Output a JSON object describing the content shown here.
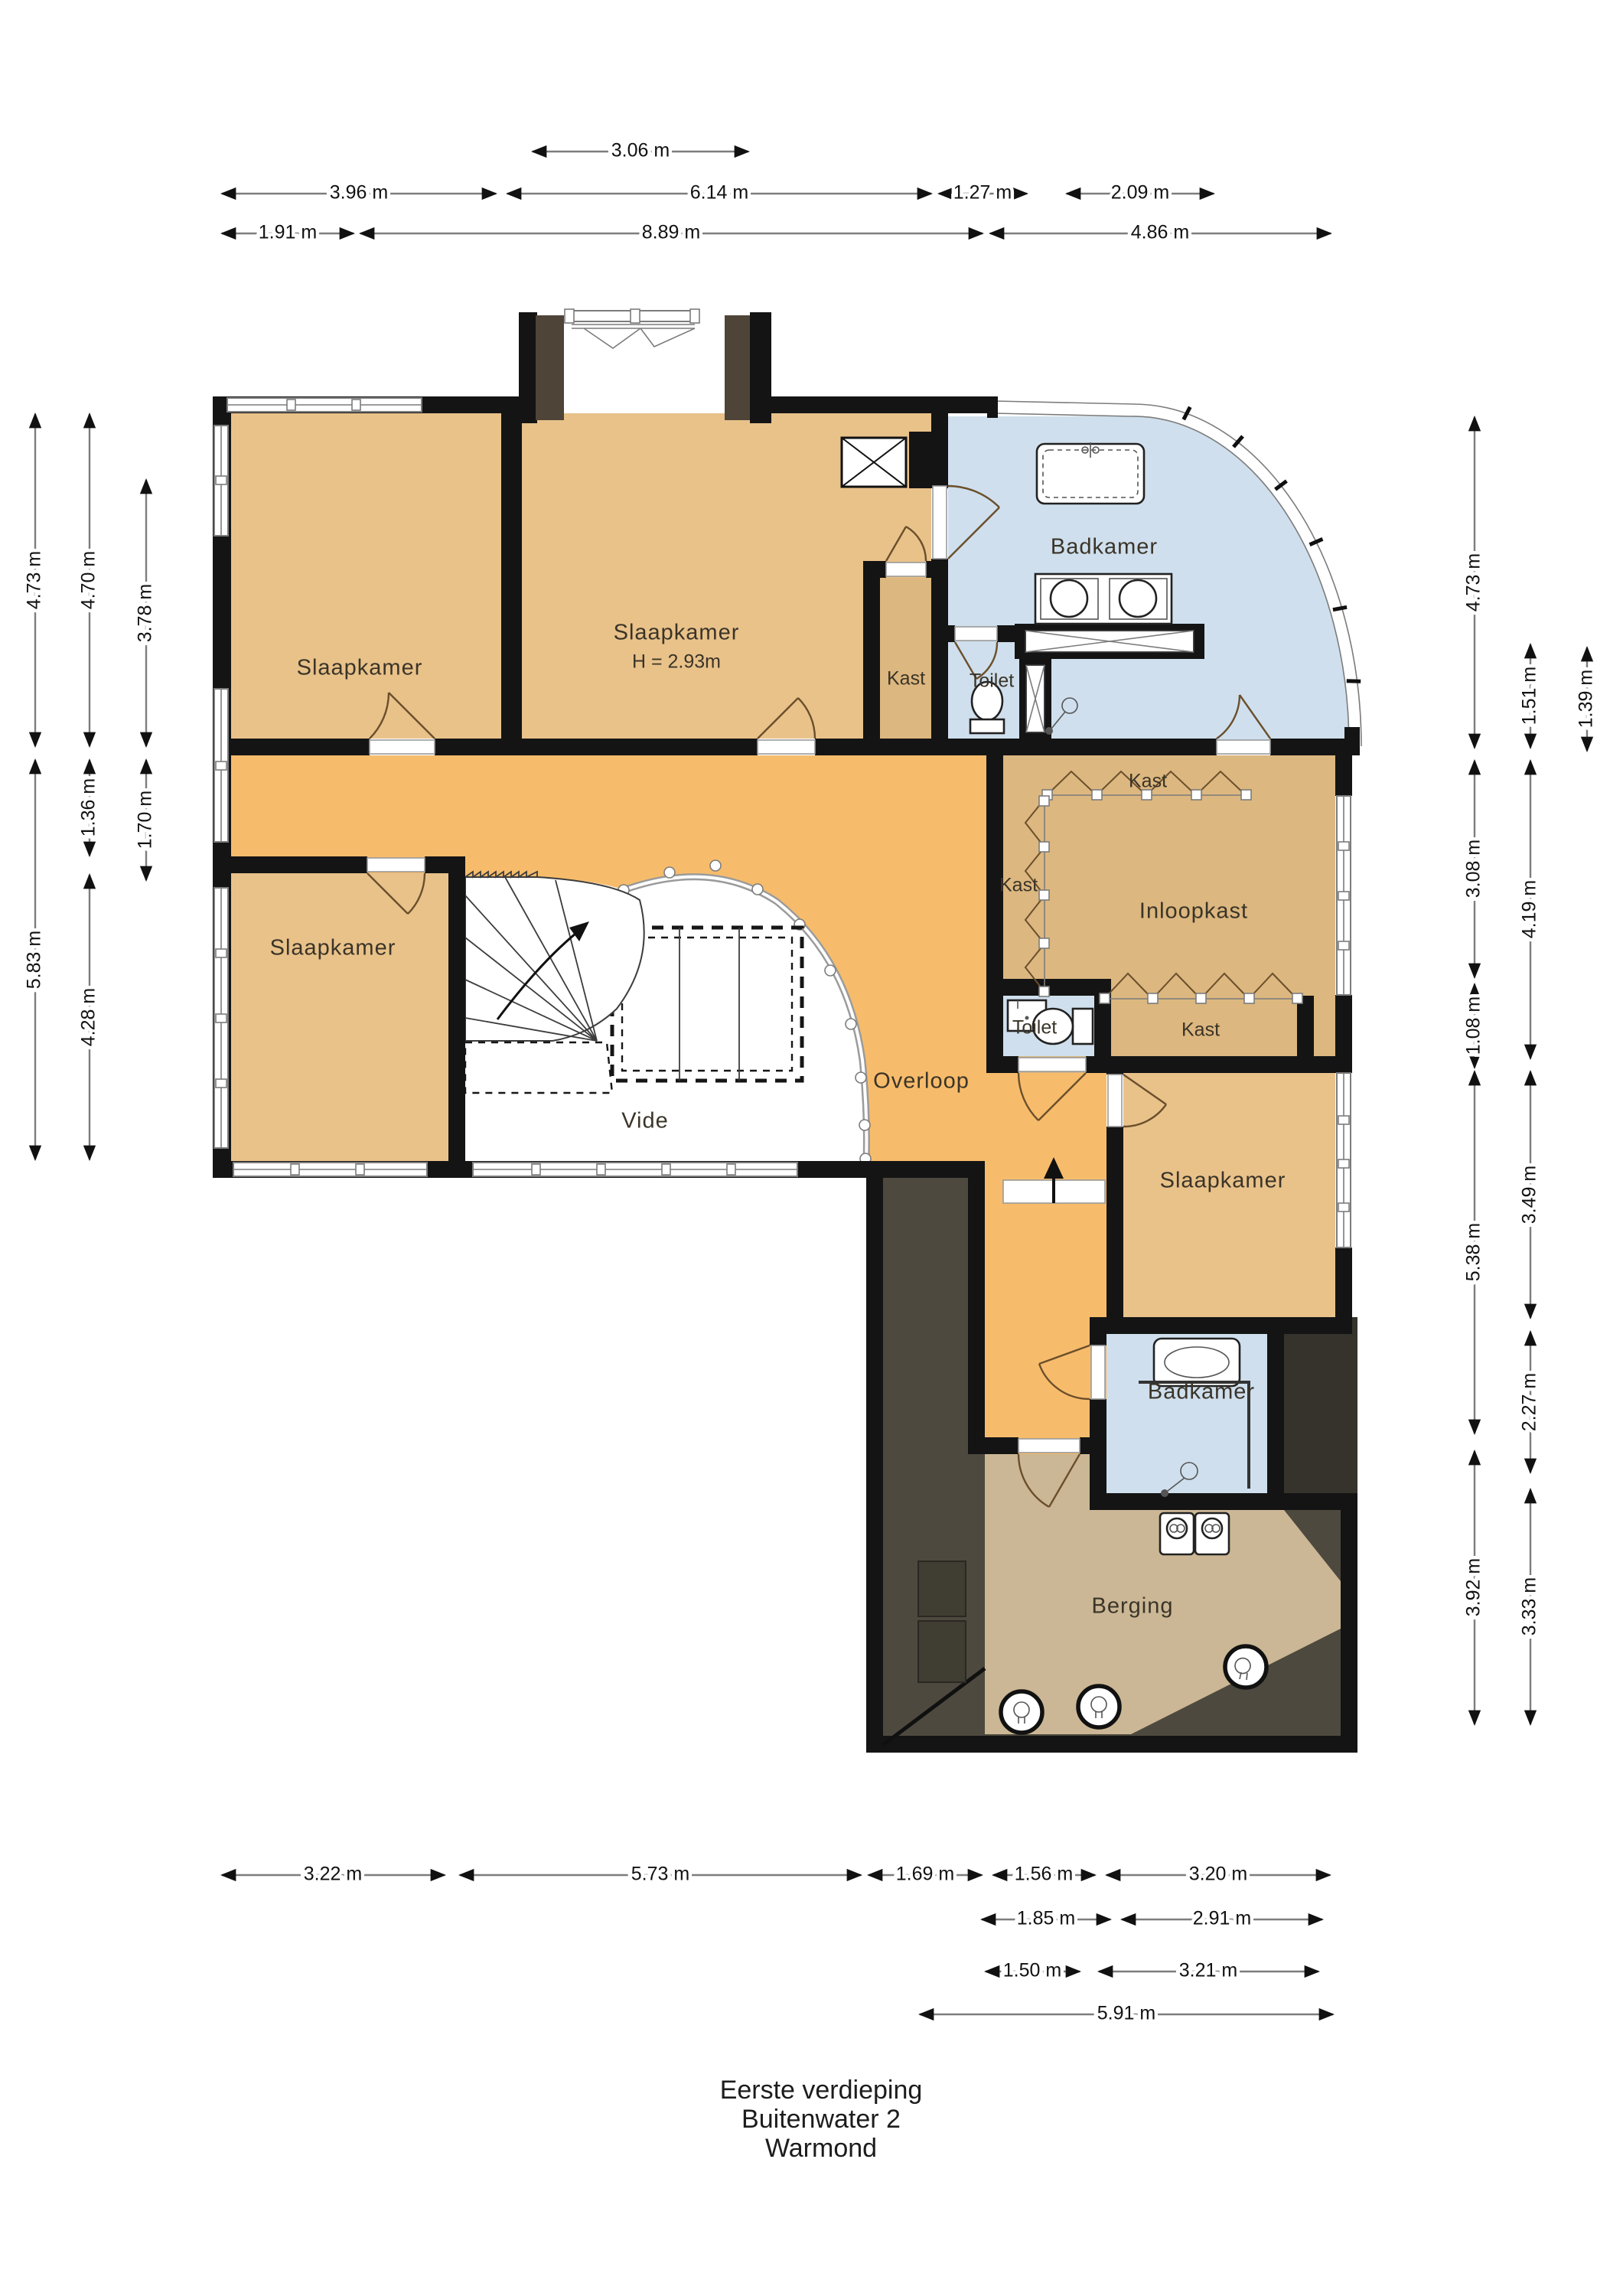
{
  "title": {
    "line1": "Eerste verdieping",
    "line2": "Buitenwater 2",
    "line3": "Warmond"
  },
  "rooms": {
    "slaapkamer_nw": {
      "label": "Slaapkamer"
    },
    "slaapkamer_n": {
      "label": "Slaapkamer",
      "height_note": "H = 2.93m"
    },
    "badkamer_n": {
      "label": "Badkamer"
    },
    "toilet_n": {
      "label": "Toilet"
    },
    "kast_slaapkamer": {
      "label": "Kast"
    },
    "kast_boven": {
      "label": "Kast"
    },
    "kast_links": {
      "label": "Kast"
    },
    "inloopkast": {
      "label": "Inloopkast"
    },
    "toilet_midden": {
      "label": "Toilet"
    },
    "kast_onder": {
      "label": "Kast"
    },
    "slaapkamer_w": {
      "label": "Slaapkamer"
    },
    "overloop": {
      "label": "Overloop"
    },
    "vide": {
      "label": "Vide"
    },
    "slaapkamer_e": {
      "label": "Slaapkamer"
    },
    "badkamer_s": {
      "label": "Badkamer"
    },
    "berging": {
      "label": "Berging"
    }
  },
  "dims": {
    "top1": [
      "3.06 m"
    ],
    "top2": [
      "3.96 m",
      "6.14 m",
      "1.27 m",
      "2.09 m"
    ],
    "top3": [
      "1.91 m",
      "8.89 m",
      "4.86 m"
    ],
    "left1": [
      "4.73 m",
      "5.83 m"
    ],
    "left2": [
      "4.70 m",
      "1.36 m",
      "4.28 m"
    ],
    "left3": [
      "3.78 m",
      "1.70 m"
    ],
    "right1": [
      "4.73 m",
      "3.08 m",
      "1.08 m",
      "5.38 m",
      "3.92 m"
    ],
    "right2": [
      "1.51 m",
      "4.19 m",
      "3.49 m",
      "2.27 m",
      "3.33 m"
    ],
    "right3": [
      "1.39 m"
    ],
    "bottom1": [
      "3.22 m",
      "5.73 m",
      "1.69 m",
      "1.56 m",
      "3.20 m"
    ],
    "bottom2": [
      "1.85 m",
      "2.91 m"
    ],
    "bottom3": [
      "1.50 m",
      "3.21 m"
    ],
    "bottom4": [
      "5.91 m"
    ]
  },
  "colors": {
    "bedroom": "#e9c28a",
    "hall": "#f7bc6b",
    "closet": "#dcb77f",
    "bath": "#cfdfed",
    "storage_floor": "#cbb795",
    "roof_dark": "#4d493e",
    "roof_charcoal": "#35332c",
    "shutter_brown": "#4f4438",
    "wall": "#141414"
  }
}
